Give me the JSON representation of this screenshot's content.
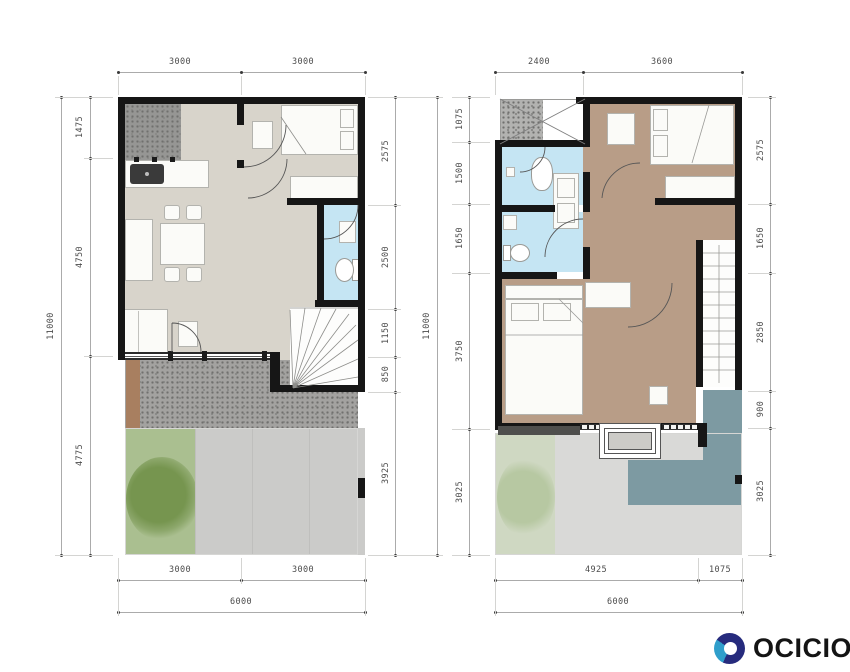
{
  "logo": {
    "text": "OCICIO"
  },
  "plans": [
    {
      "label": "ground-floor",
      "top": [
        "3000",
        "3000"
      ],
      "bottom": [
        "3000",
        "3000"
      ],
      "bottom_overall": "6000",
      "left": [
        "1475",
        "4750",
        "4775"
      ],
      "left_overall": "11000",
      "right": [
        "2575",
        "2500",
        "1150",
        "850",
        "3925"
      ],
      "right_overall": "11000"
    },
    {
      "label": "upper-floor",
      "top": [
        "2400",
        "3600"
      ],
      "bottom": [
        "4925",
        "1075"
      ],
      "bottom_overall": "6000",
      "left": [
        "1075",
        "1500",
        "1650",
        "3750",
        "3025"
      ],
      "right": [
        "2575",
        "1650",
        "2850",
        "900",
        "3025"
      ]
    }
  ],
  "colors": {
    "wall": "#161616",
    "floor": "#d8d4cb",
    "wood": "#b89d87",
    "bath": "#c5e5f3",
    "teal": "#7d9aa2",
    "garden": "#aabf90",
    "garden_tree": "#76954f",
    "garden_pale": "#cfd8c2",
    "gravel": "#a3a2a0",
    "drive": "#cbcbc9",
    "drive2": "#d9d9d7",
    "utility": "#969694",
    "deck_brown": "#a87f60",
    "furn": "#fbfbf8",
    "logo_navy": "#262b7d",
    "logo_blue": "#2f9ecb",
    "logo_text": "#141414"
  }
}
